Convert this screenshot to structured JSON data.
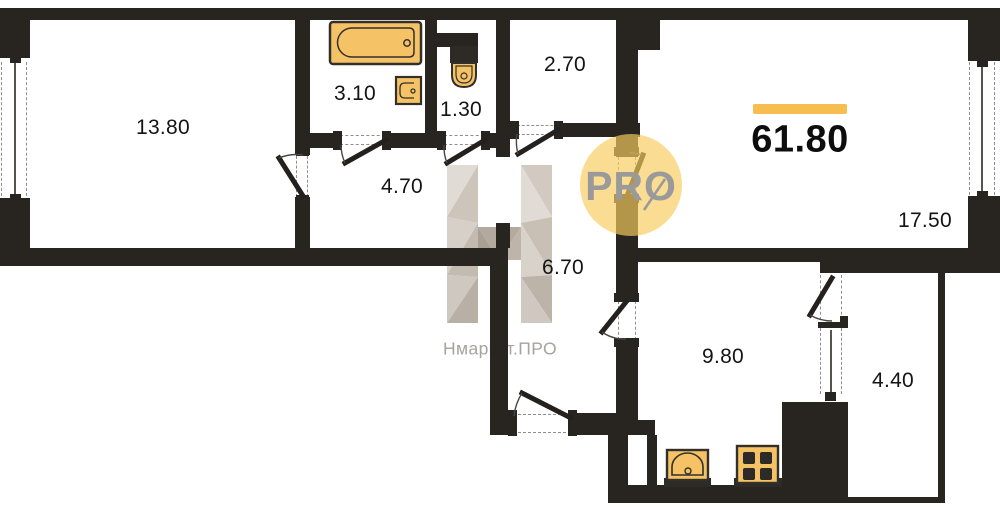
{
  "plan": {
    "total_area_label": "61.80",
    "rooms": [
      {
        "name": "bedroom",
        "area_label": "13.80"
      },
      {
        "name": "bathroom",
        "area_label": "3.10"
      },
      {
        "name": "wc",
        "area_label": "1.30"
      },
      {
        "name": "storage",
        "area_label": "2.70"
      },
      {
        "name": "hallway",
        "area_label": "4.70"
      },
      {
        "name": "corridor",
        "area_label": "6.70"
      },
      {
        "name": "living-room",
        "area_label": "17.50"
      },
      {
        "name": "kitchen",
        "area_label": "9.80"
      },
      {
        "name": "balcony",
        "area_label": "4.40"
      }
    ],
    "fixtures": [
      "bathtub",
      "bathroom-sink",
      "toilet",
      "kitchen-sink",
      "stove"
    ],
    "watermark": {
      "logo_text": "PRO",
      "brand_text": "Нмаркет.ПРО"
    },
    "colors": {
      "wall": "#282420",
      "fixture_fill": "#F5C266",
      "fixture_stroke": "#33302B",
      "accent_bar": "#F6BE4E",
      "dash_gray": "#8F8F8F",
      "watermark_gray": "#9A9A9A",
      "watermark_circle": "rgba(247,205,95,0.68)"
    }
  }
}
